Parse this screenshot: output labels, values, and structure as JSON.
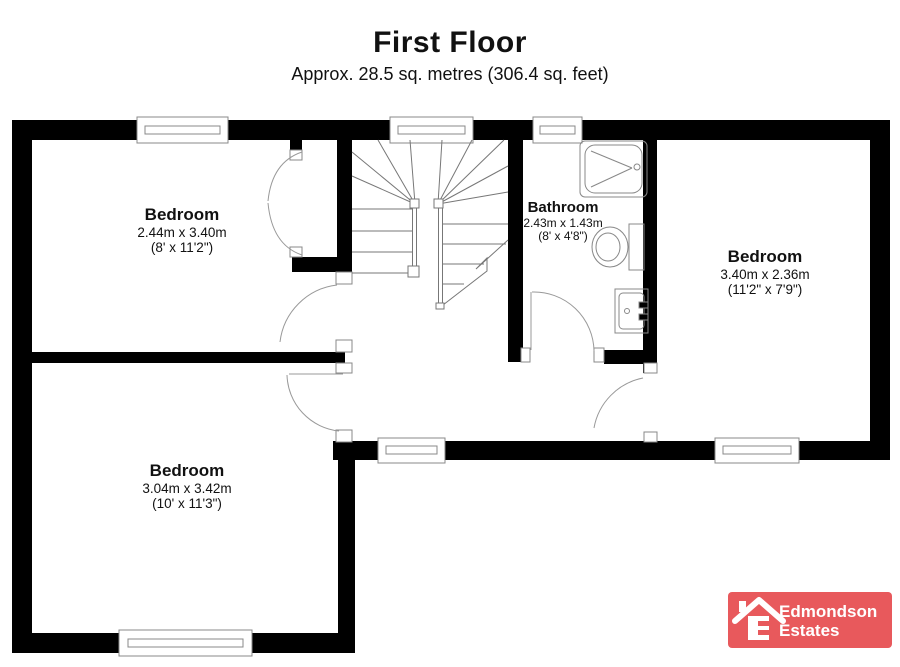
{
  "header": {
    "title": "First Floor",
    "subtitle": "Approx. 28.5 sq. metres (306.4 sq. feet)"
  },
  "rooms": [
    {
      "name": "Bedroom",
      "metric": "2.44m x 3.40m",
      "imperial": "(8' x 11'2\")"
    },
    {
      "name": "Bathroom",
      "metric": "2.43m x 1.43m",
      "imperial": "(8' x 4'8\")"
    },
    {
      "name": "Bedroom",
      "metric": "3.40m x 2.36m",
      "imperial": "(11'2\" x 7'9\")"
    },
    {
      "name": "Bedroom",
      "metric": "3.04m x 3.42m",
      "imperial": "(10' x 11'3\")"
    }
  ],
  "logo": {
    "line1": "Edmondson",
    "line2": "Estates",
    "icon": "house-icon",
    "background": "#e8595c"
  },
  "colors": {
    "walls": "#000000",
    "thin_lines": "#777777",
    "door_arcs": "#999999",
    "logo_red": "#e8595c"
  }
}
